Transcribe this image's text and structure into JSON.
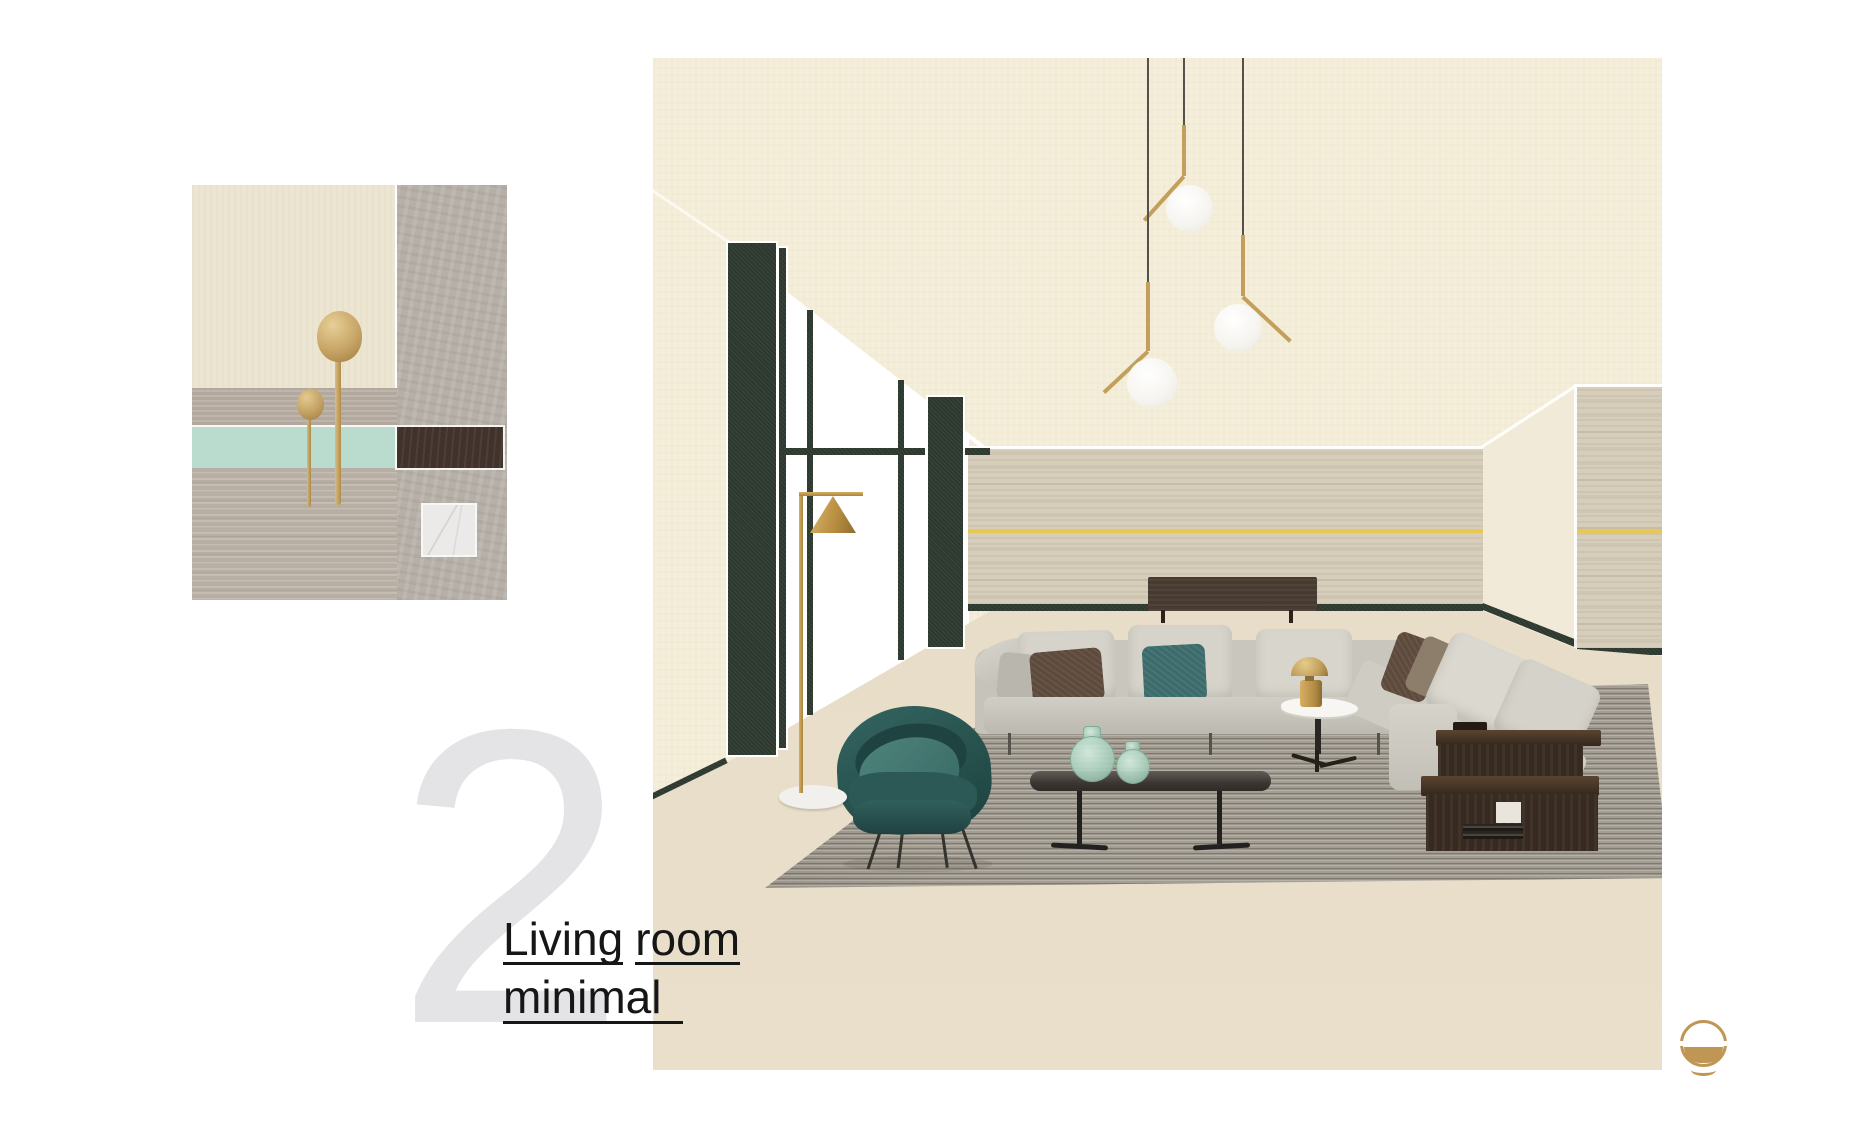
{
  "page": {
    "number": "2",
    "background": "#ffffff"
  },
  "title": {
    "word1": "Living",
    "word2": "room",
    "line2": "minimal"
  },
  "logo": {
    "description": "brass-circle-mark"
  },
  "palette": {
    "page_bg": "#ffffff",
    "number_gray": "#e4e4e6",
    "text": "#161616",
    "logo_gold": "#bf9654",
    "cream": "#f4eeda",
    "corner_wall": "#f1ead8",
    "travertine": "#d6cdbb",
    "green": "#2d382e",
    "brass_line": "#e8c84e",
    "floor": "#e6dcc7",
    "rug": "#a39d92",
    "sofa": "#cbc8bf",
    "cushion": "#d6d3ca",
    "pillow_brown": "#5d4a3c",
    "pillow_teal": "#3c6b6b",
    "chair_teal": "#2e5d5a",
    "walnut": "#372b21",
    "sideboard": "#473a30",
    "gold": "#c2a05c",
    "wire": "#54514a",
    "glass_green": "#a6cbba",
    "plaster": "#ece5d2",
    "concrete": "#b7b0a9",
    "stone_band": "#b2a89d",
    "mint": "#badcce",
    "walnut_swatch": "#41332b",
    "travertine_rough": "#b8afa4",
    "marble": "#eceae8"
  },
  "moodboard": {
    "swatches": [
      {
        "name": "plaster-cream",
        "color": "#ece5d2"
      },
      {
        "name": "concrete",
        "color": "#b7b0a9"
      },
      {
        "name": "stone-band",
        "color": "#b2a89d"
      },
      {
        "name": "mint-lacquer",
        "color": "#badcce"
      },
      {
        "name": "dark-walnut",
        "color": "#41332b"
      },
      {
        "name": "travertine",
        "color": "#b8afa4"
      },
      {
        "name": "carrara-marble",
        "color": "#eceae8"
      },
      {
        "name": "brass-cutlery",
        "color": "#c7a466"
      }
    ]
  },
  "scene": {
    "elements": [
      "pendant-lights",
      "window-wall",
      "green-pillars",
      "travertine-wall",
      "brass-accent-line",
      "sideboard",
      "modular-sofa",
      "velvet-armchair",
      "coffee-table",
      "glass-vases",
      "side-table",
      "brass-table-lamp",
      "walnut-shelf-unit",
      "floor-lamp",
      "area-rug"
    ]
  }
}
